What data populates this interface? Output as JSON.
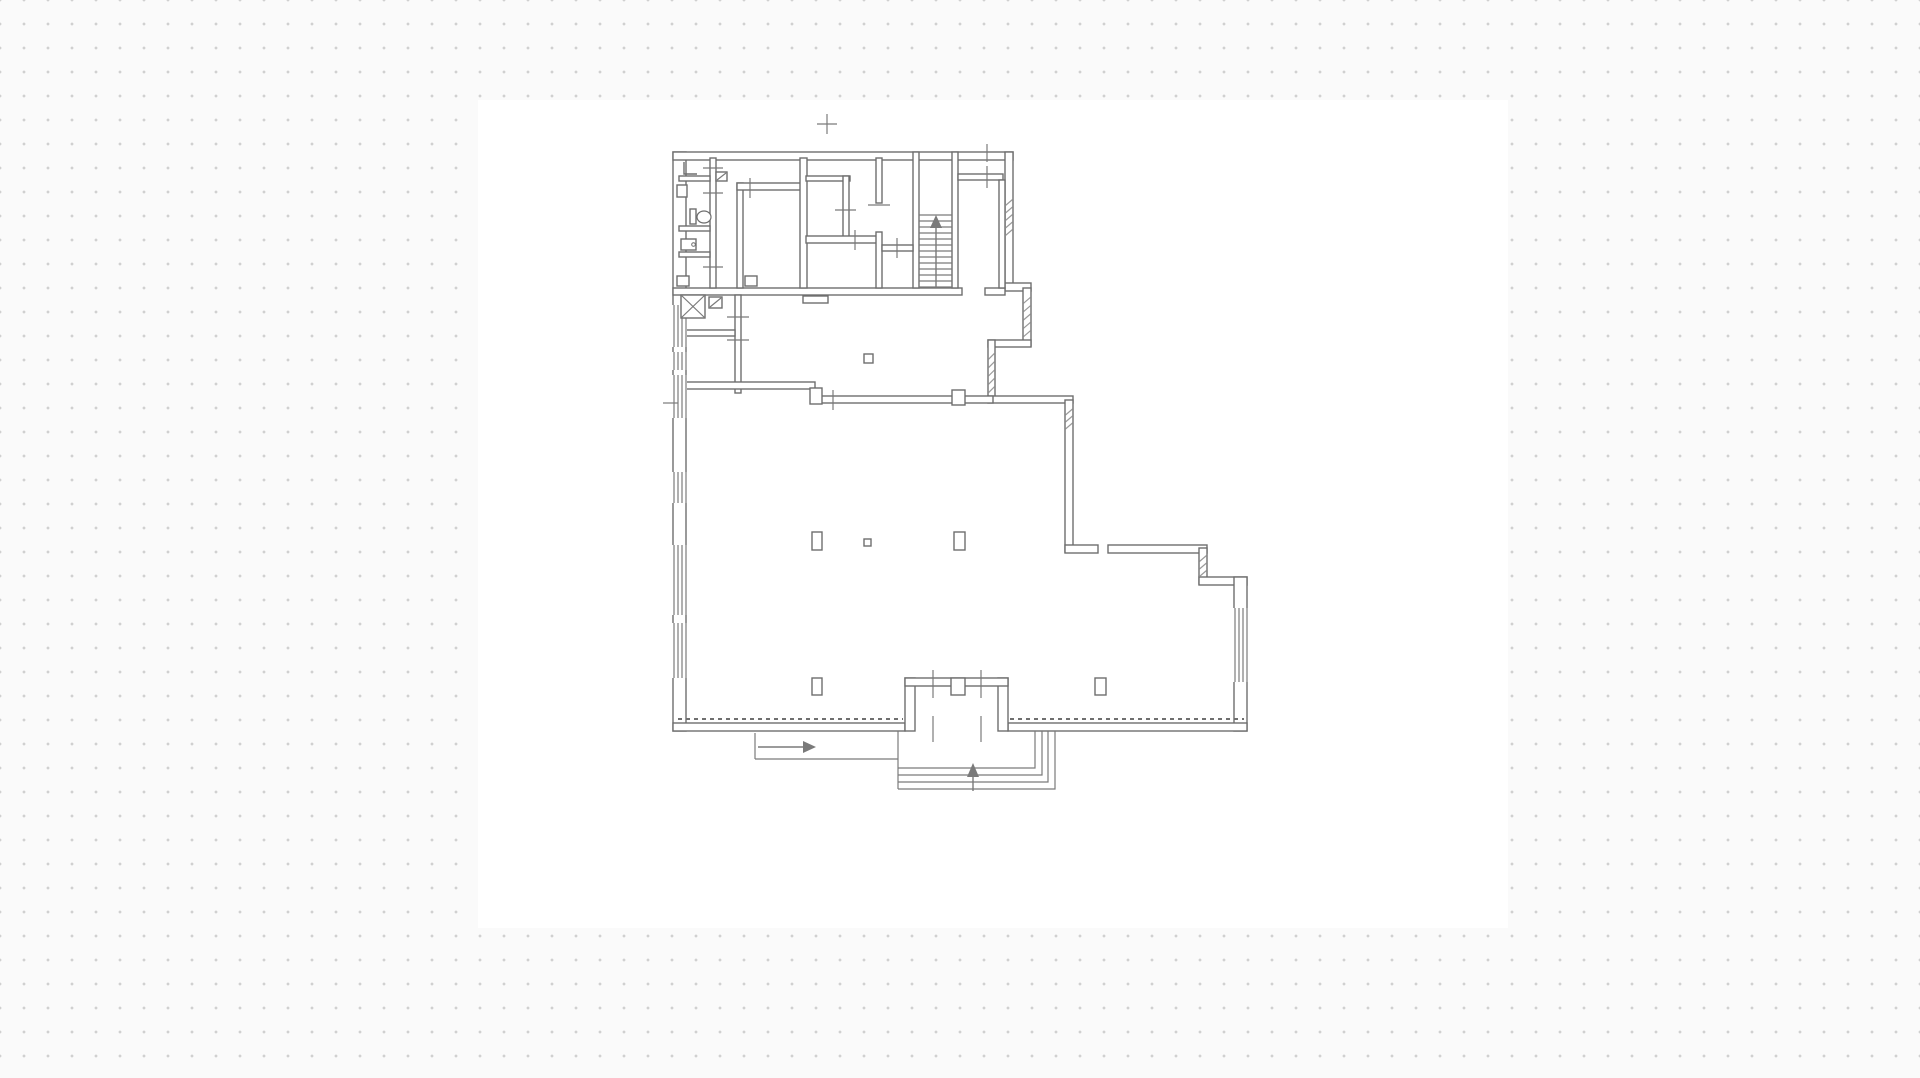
{
  "meta": {
    "width": 1920,
    "height": 1078,
    "app_kind": "floor-plan-viewer"
  },
  "canvas": {
    "background": "#fafafa",
    "dot_color": "#d0d0d0",
    "dot_spacing": 24,
    "sheet": {
      "x": 478,
      "y": 100,
      "w": 1030,
      "h": 828,
      "fill": "#ffffff"
    }
  },
  "style": {
    "wall_stroke": "#6e6e6e",
    "wall_fill": "#ffffff",
    "thin_stroke": "#7a7a7a",
    "dash_stroke": "#6f6f6f",
    "hatch_stroke": "#9a9a9a",
    "wall_width": 1.4,
    "thin_width": 1.2
  },
  "floorplan": {
    "walls": [
      {
        "name": "exterior-left-wall",
        "r": [
          673,
          152,
          13,
          579
        ]
      },
      {
        "name": "exterior-top-wall",
        "r": [
          673,
          152,
          340,
          8
        ]
      },
      {
        "name": "exterior-right-upper-wall",
        "r": [
          1005,
          152,
          8,
          135
        ]
      },
      {
        "name": "step-out-wall",
        "r": [
          1005,
          283,
          26,
          8
        ]
      },
      {
        "name": "notch-right-wall",
        "r": [
          1023,
          288,
          8,
          58
        ]
      },
      {
        "name": "notch-top-wall",
        "r": [
          988,
          340,
          43,
          7
        ]
      },
      {
        "name": "notch-left-wall",
        "r": [
          988,
          340,
          7,
          62
        ]
      },
      {
        "name": "main-room-top-ext-wall",
        "r": [
          988,
          396,
          85,
          7
        ]
      },
      {
        "name": "exterior-right-mid-wall",
        "r": [
          1065,
          400,
          8,
          152
        ]
      },
      {
        "name": "right-ext-wall-a",
        "r": [
          1065,
          545,
          33,
          8
        ]
      },
      {
        "name": "right-ext-wall-b",
        "r": [
          1108,
          545,
          99,
          8
        ]
      },
      {
        "name": "right-step-down-wall",
        "r": [
          1199,
          548,
          8,
          36
        ]
      },
      {
        "name": "right-ext-wall-c",
        "r": [
          1199,
          577,
          48,
          8
        ]
      },
      {
        "name": "exterior-right-lower-wall",
        "r": [
          1234,
          577,
          13,
          154
        ]
      },
      {
        "name": "exterior-bottom-wall-left",
        "r": [
          673,
          723,
          232,
          8
        ]
      },
      {
        "name": "exterior-bottom-wall-right",
        "r": [
          1008,
          723,
          239,
          8
        ]
      },
      {
        "name": "upper-block-bottom-wall",
        "r": [
          673,
          288,
          289,
          7
        ]
      },
      {
        "name": "upper-block-bottom-stub",
        "r": [
          985,
          288,
          20,
          7
        ]
      },
      {
        "name": "sanitary-strip-wall",
        "r": [
          710,
          158,
          6,
          130
        ]
      },
      {
        "name": "sanitary-divider-1",
        "r": [
          679,
          176,
          31,
          5
        ]
      },
      {
        "name": "sanitary-divider-2",
        "r": [
          679,
          226,
          31,
          5
        ]
      },
      {
        "name": "sanitary-divider-3",
        "r": [
          679,
          252,
          31,
          5
        ]
      },
      {
        "name": "inner-room-left-wall",
        "r": [
          737,
          183,
          6,
          105
        ]
      },
      {
        "name": "inner-room-top-wall",
        "r": [
          737,
          183,
          69,
          7
        ]
      },
      {
        "name": "partition-wall-a",
        "r": [
          800,
          158,
          7,
          130
        ]
      },
      {
        "name": "partition-wall-b",
        "r": [
          806,
          176,
          44,
          5
        ]
      },
      {
        "name": "partition-wall-c",
        "r": [
          843,
          176,
          6,
          65
        ]
      },
      {
        "name": "partition-wall-d",
        "r": [
          806,
          236,
          72,
          7
        ]
      },
      {
        "name": "strip-wall-upper",
        "r": [
          876,
          158,
          6,
          45
        ]
      },
      {
        "name": "strip-wall-lower",
        "r": [
          876,
          232,
          6,
          56
        ]
      },
      {
        "name": "stair-wall-left",
        "r": [
          913,
          152,
          6,
          136
        ]
      },
      {
        "name": "strip-divider",
        "r": [
          882,
          245,
          31,
          6
        ]
      },
      {
        "name": "stair-wall-right",
        "r": [
          952,
          152,
          6,
          136
        ]
      },
      {
        "name": "topright-room-bottom-wall",
        "r": [
          958,
          174,
          45,
          6
        ]
      },
      {
        "name": "topright-corridor-wall",
        "r": [
          999,
          180,
          6,
          108
        ]
      },
      {
        "name": "hall-vertical-wall",
        "r": [
          735,
          295,
          6,
          98
        ]
      },
      {
        "name": "hall-horizontal-wall",
        "r": [
          679,
          330,
          56,
          6
        ]
      },
      {
        "name": "main-room-top-wall-left",
        "r": [
          679,
          382,
          136,
          7
        ]
      },
      {
        "name": "main-room-top-wall-right",
        "r": [
          820,
          396,
          173,
          7
        ]
      },
      {
        "name": "vestibule-left-wall",
        "r": [
          905,
          678,
          10,
          53
        ]
      },
      {
        "name": "vestibule-right-wall",
        "r": [
          998,
          678,
          10,
          53
        ]
      },
      {
        "name": "vestibule-top-wall",
        "r": [
          905,
          678,
          103,
          8
        ]
      }
    ],
    "windows_left": {
      "mask_x": 672,
      "mask_w": 15,
      "line_xs": [
        674,
        678,
        682,
        686
      ],
      "bands": [
        [
          305,
          347
        ],
        [
          352,
          370
        ],
        [
          375,
          418
        ],
        [
          472,
          503
        ],
        [
          545,
          615
        ],
        [
          623,
          678
        ]
      ]
    },
    "window_right": {
      "mask": [
        1233,
        608,
        15,
        74
      ],
      "line_xs": [
        1235,
        1239,
        1243,
        1247
      ],
      "y1": 608,
      "y2": 682
    },
    "tabs": [
      {
        "name": "door-tab-wc",
        "r": [
          677,
          185,
          10,
          12
        ]
      },
      {
        "name": "door-tab-sanitary",
        "r": [
          677,
          276,
          12,
          10
        ]
      },
      {
        "name": "door-tab-inner-room",
        "r": [
          745,
          276,
          12,
          10
        ]
      },
      {
        "name": "door-recess",
        "r": [
          803,
          296,
          25,
          7
        ]
      },
      {
        "name": "pilaster-wall-junction",
        "r": [
          810,
          388,
          12,
          16
        ]
      },
      {
        "name": "pilaster-top-wall",
        "r": [
          952,
          390,
          13,
          15
        ]
      },
      {
        "name": "vestibule-door-tab",
        "r": [
          951,
          678,
          14,
          17
        ]
      },
      {
        "name": "door-leaf-square",
        "r": [
          709,
          297,
          13,
          11
        ]
      },
      {
        "name": "fixture-square",
        "r": [
          716,
          172,
          11,
          9
        ]
      }
    ],
    "columns": [
      {
        "name": "column",
        "r": [
          812,
          532,
          10,
          18
        ]
      },
      {
        "name": "column-small",
        "r": [
          864,
          539,
          7,
          7
        ]
      },
      {
        "name": "column",
        "r": [
          954,
          532,
          11,
          18
        ]
      },
      {
        "name": "column",
        "r": [
          812,
          678,
          10,
          17
        ]
      },
      {
        "name": "column",
        "r": [
          1095,
          678,
          11,
          17
        ]
      },
      {
        "name": "column-hall",
        "r": [
          864,
          354,
          9,
          9
        ]
      }
    ],
    "shaft_x": {
      "r": [
        681,
        295,
        24,
        23
      ]
    },
    "stairs": {
      "x1": 919,
      "x2": 952,
      "y_start": 215,
      "y_end": 287,
      "count": 13
    },
    "exterior_steps": [
      [
        898,
        768,
        1035,
        768,
        1035,
        731
      ],
      [
        898,
        775,
        1042,
        775,
        1042,
        731
      ],
      [
        898,
        782,
        1048,
        782,
        1048,
        731
      ],
      [
        898,
        789,
        1055,
        789,
        1055,
        731
      ]
    ],
    "lines": [
      {
        "name": "walkway-edge-left",
        "p": [
          755,
          733,
          755,
          759
        ]
      },
      {
        "name": "walkway-edge-bottom",
        "p": [
          755,
          759,
          898,
          759
        ]
      },
      {
        "name": "exterior-steps-left-edge",
        "p": [
          898,
          731,
          898,
          789
        ]
      }
    ],
    "dashed_lines": [
      {
        "name": "storefront-dashed-line",
        "p": [
          678,
          719,
          903,
          719
        ]
      },
      {
        "name": "storefront-dashed-line",
        "p": [
          1010,
          719,
          1244,
          719
        ]
      }
    ],
    "ticks": [
      {
        "name": "door-tick",
        "p": [
          703,
          168,
          723,
          168
        ]
      },
      {
        "name": "door-tick",
        "p": [
          703,
          193,
          723,
          193
        ]
      },
      {
        "name": "door-tick",
        "p": [
          703,
          267,
          723,
          267
        ]
      },
      {
        "name": "door-tick",
        "p": [
          750,
          178,
          750,
          198
        ]
      },
      {
        "name": "door-tick",
        "p": [
          855,
          230,
          855,
          250
        ]
      },
      {
        "name": "door-tick",
        "p": [
          897,
          238,
          897,
          258
        ]
      },
      {
        "name": "door-tick",
        "p": [
          868,
          205,
          890,
          205
        ]
      },
      {
        "name": "door-tick",
        "p": [
          835,
          210,
          856,
          210
        ]
      },
      {
        "name": "door-tick",
        "p": [
          987,
          166,
          987,
          188
        ]
      },
      {
        "name": "door-tick",
        "p": [
          987,
          144,
          987,
          162
        ]
      },
      {
        "name": "dim-tick",
        "p": [
          817,
          124,
          837,
          124
        ]
      },
      {
        "name": "dim-tick",
        "p": [
          827,
          114,
          827,
          134
        ]
      },
      {
        "name": "door-tick",
        "p": [
          833,
          390,
          833,
          410
        ]
      },
      {
        "name": "door-tick",
        "p": [
          727,
          317,
          749,
          317
        ]
      },
      {
        "name": "door-tick",
        "p": [
          727,
          340,
          749,
          340
        ]
      },
      {
        "name": "window-tick",
        "p": [
          663,
          403,
          678,
          403
        ]
      },
      {
        "name": "door-tick",
        "p": [
          933,
          670,
          933,
          698
        ]
      },
      {
        "name": "door-tick",
        "p": [
          981,
          670,
          981,
          698
        ]
      },
      {
        "name": "door-tick",
        "p": [
          933,
          716,
          933,
          742
        ]
      },
      {
        "name": "door-tick",
        "p": [
          981,
          716,
          981,
          742
        ]
      }
    ],
    "arrows": [
      {
        "name": "stair-up-arrow",
        "shaft": [
          936,
          288,
          936,
          226
        ],
        "head": [
          936,
          215,
          930,
          228,
          942,
          228
        ]
      },
      {
        "name": "entry-up-arrow",
        "shaft": [
          973,
          791,
          973,
          774
        ],
        "head": [
          973,
          763,
          967,
          777,
          979,
          777
        ]
      },
      {
        "name": "entry-direction-arrow",
        "shaft": [
          758,
          747,
          806,
          747
        ],
        "head": [
          816,
          747,
          803,
          741,
          803,
          753
        ]
      }
    ],
    "hatches": [
      {
        "r": [
          1005,
          195,
          8,
          45
        ],
        "n": 5
      },
      {
        "r": [
          1023,
          292,
          8,
          50
        ],
        "n": 5
      },
      {
        "r": [
          988,
          348,
          7,
          50
        ],
        "n": 5
      },
      {
        "r": [
          1065,
          405,
          8,
          28
        ],
        "n": 3
      },
      {
        "r": [
          1199,
          551,
          8,
          30
        ],
        "n": 3
      }
    ],
    "fixtures": {
      "toilet": {
        "tank": [
          690,
          209,
          6,
          15
        ],
        "bowl_c": [
          704,
          217
        ],
        "bowl_r": [
          7,
          6
        ]
      },
      "sink": {
        "r": [
          681,
          239,
          15,
          11
        ],
        "dot": [
          693.5,
          244.5,
          1.8
        ]
      },
      "pipe_path": "M684,162 v12 h13",
      "leaf_diagonals": [
        [
          710,
          307,
          721,
          298
        ],
        [
          717,
          180,
          726,
          173
        ]
      ],
      "shaft_diagonals": [
        [
          681,
          295,
          705,
          318
        ],
        [
          705,
          295,
          681,
          318
        ]
      ]
    }
  }
}
